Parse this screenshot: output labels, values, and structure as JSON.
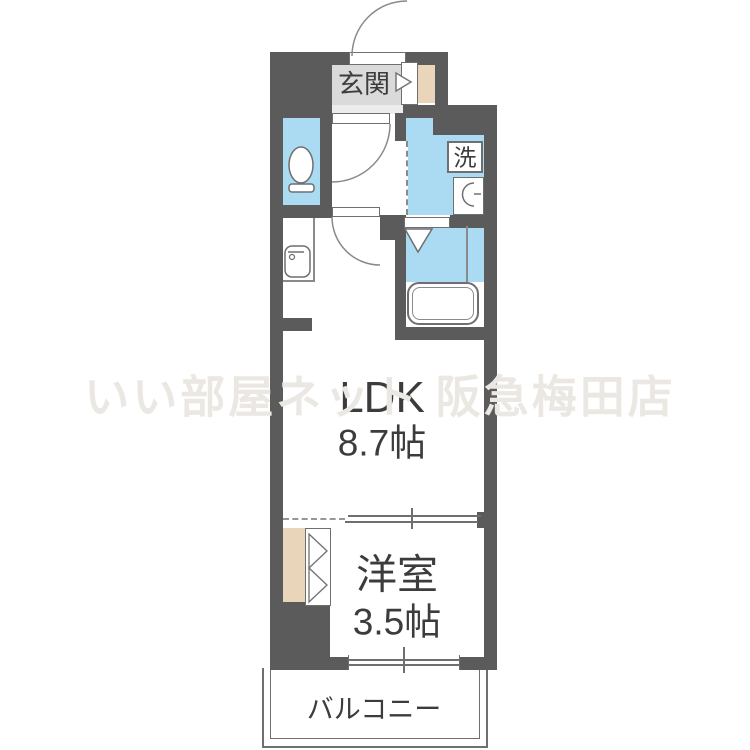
{
  "watermark": "いい部屋ネット 阪急梅田店",
  "labels": {
    "genkan": "玄関",
    "laundry": "洗",
    "ldk_name": "LDK",
    "ldk_size": "8.7帖",
    "western_name": "洋室",
    "western_size": "3.5帖",
    "balcony": "バルコニー"
  },
  "rooms": [
    {
      "name": "玄関",
      "type": "entrance"
    },
    {
      "name": "LDK",
      "size": "8.7帖"
    },
    {
      "name": "洋室",
      "size": "3.5帖"
    },
    {
      "name": "バルコニー",
      "type": "balcony"
    },
    {
      "name": "トイレ",
      "type": "toilet"
    },
    {
      "name": "洗面室",
      "type": "washroom"
    },
    {
      "name": "浴室",
      "type": "bathroom"
    }
  ],
  "colors": {
    "wall": "#5b5b5b",
    "water_blue": "#abdaf3",
    "wood_beige": "#e9d6ba",
    "genkan_gray": "#dadada",
    "text": "#3c3c3c",
    "watermark_gray": "#ebe8e3",
    "line": "#6f6f6f"
  },
  "icons": {
    "toilet-icon": "oval bowl with base",
    "bathtub-icon": "double rounded rectangle",
    "washbasin-icon": "half circle with tap",
    "kitchen-sink-icon": "rounded square with faucet",
    "washing-machine-icon": "boxed kanji 洗",
    "door-swing-icon": "quarter arc",
    "sliding-door-icon": "offset parallel lines",
    "folding-door-icon": "double chevron",
    "entrance-arrow-icon": "right-pointing triangle"
  }
}
